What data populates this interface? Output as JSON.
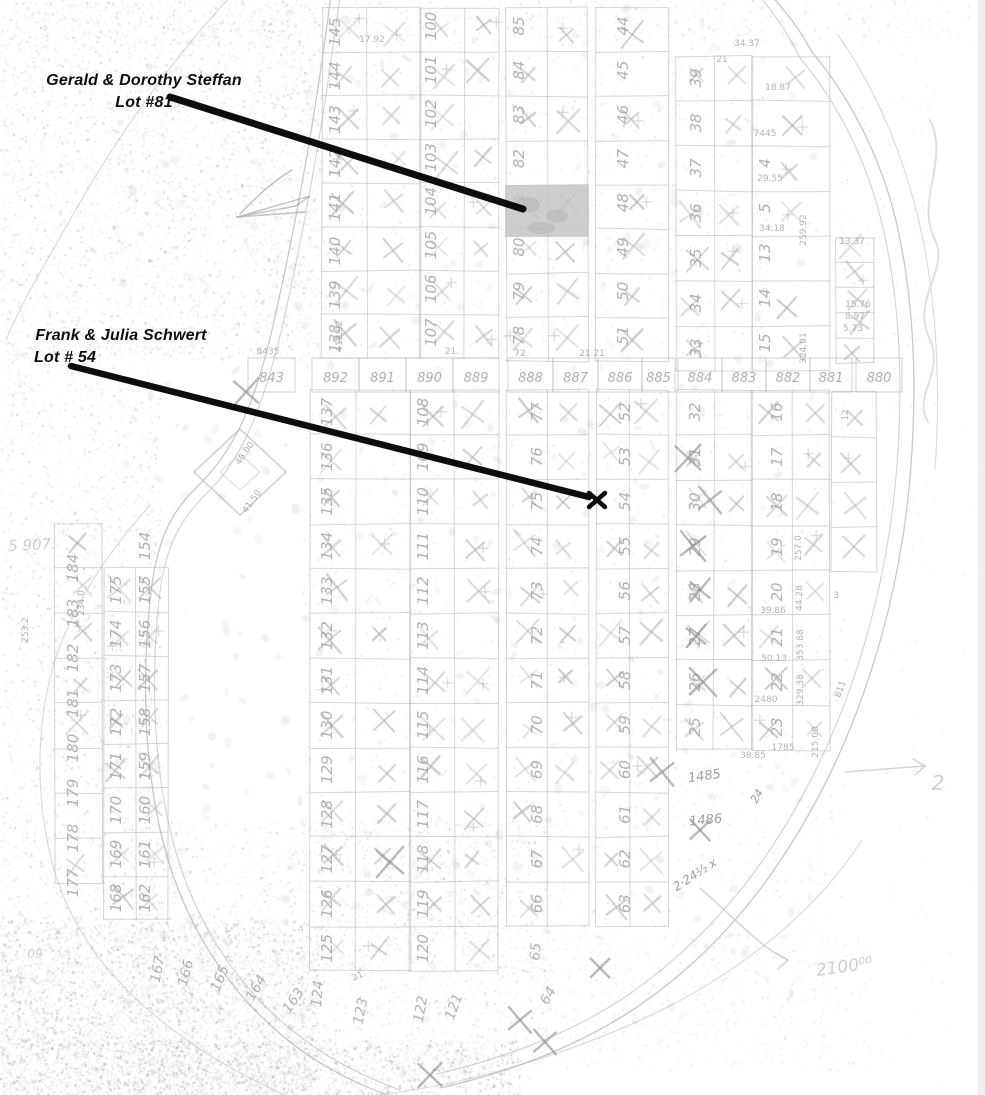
{
  "document": {
    "kind": "scanned plat map with ownership annotations"
  },
  "colors": {
    "background": "#ffffff",
    "annotation_ink": "#0d0d0d",
    "map_line_ink": "#b6b6b6",
    "lot_number_ink": "#a2a2a2",
    "dimension_ink": "#a6a6a6",
    "pencil_ink": "#8d8d8d",
    "handwriting_ink": "#c9c9c9",
    "highlight_fill": "#c5c5c5"
  },
  "annotations": {
    "steffan": {
      "name_line": "Gerald & Dorothy Steffan",
      "lot_line": "Lot #81",
      "pointer": {
        "x1": 170,
        "y1": 97,
        "x2": 523,
        "y2": 209,
        "width": 7
      },
      "highlight": {
        "x": 505,
        "y": 185,
        "w": 84,
        "h": 52
      }
    },
    "schwert": {
      "name_line": "Frank & Julia Schwert",
      "lot_line": "Lot # 54",
      "pointer": {
        "x1": 71,
        "y1": 366,
        "x2": 589,
        "y2": 497,
        "width": 6.5
      },
      "marker": {
        "symbol": "x",
        "x": 597,
        "y": 500
      }
    }
  },
  "map": {
    "middle_band": {
      "y": 358,
      "h": 34,
      "lots": [
        {
          "n": "843",
          "x": 248,
          "w": 47
        },
        {
          "n": "892",
          "x": 312,
          "w": 47
        },
        {
          "n": "891",
          "x": 359,
          "w": 47
        },
        {
          "n": "890",
          "x": 406,
          "w": 47
        },
        {
          "n": "889",
          "x": 453,
          "w": 46
        },
        {
          "n": "888",
          "x": 508,
          "w": 45
        },
        {
          "n": "887",
          "x": 553,
          "w": 45
        },
        {
          "n": "886",
          "x": 598,
          "w": 44
        },
        {
          "n": "885",
          "x": 642,
          "w": 33
        },
        {
          "n": "884",
          "x": 678,
          "w": 44
        },
        {
          "n": "883",
          "x": 722,
          "w": 44
        },
        {
          "n": "882",
          "x": 766,
          "w": 44
        },
        {
          "n": "881",
          "x": 810,
          "w": 42
        },
        {
          "n": "880",
          "x": 856,
          "w": 46
        }
      ]
    },
    "grids": [
      {
        "x0": 322,
        "x1": 420,
        "mid": 367,
        "y0": 8,
        "rowH": 43.8,
        "n": 8
      },
      {
        "x0": 420,
        "x1": 498,
        "mid": 464,
        "y0": 8,
        "rowH": 43.8,
        "n": 8
      },
      {
        "x0": 506,
        "x1": 588,
        "mid": 548,
        "y0": 8,
        "rowH": 44.2,
        "n": 8
      },
      {
        "x0": 596,
        "x1": 668,
        "mid": 0,
        "y0": 8,
        "rowH": 44.2,
        "n": 8
      },
      {
        "x0": 676,
        "x1": 752,
        "mid": 714,
        "y0": 56,
        "rowH": 45,
        "n": 7
      },
      {
        "x0": 752,
        "x1": 830,
        "mid": 0,
        "y0": 56,
        "rowH": 45,
        "n": 7
      },
      {
        "x0": 836,
        "x1": 874,
        "mid": 0,
        "y0": 238,
        "rowH": 25,
        "n": 5
      },
      {
        "x0": 55,
        "x1": 102,
        "mid": 0,
        "y0": 523,
        "rowH": 45,
        "n": 8
      },
      {
        "x0": 104,
        "x1": 168,
        "mid": 136,
        "y0": 568,
        "rowH": 44,
        "n": 8
      },
      {
        "x0": 310,
        "x1": 410,
        "mid": 356,
        "y0": 390,
        "rowH": 44.7,
        "n": 13
      },
      {
        "x0": 410,
        "x1": 498,
        "mid": 455,
        "y0": 390,
        "rowH": 44.7,
        "n": 13
      },
      {
        "x0": 506,
        "x1": 588,
        "mid": 548,
        "y0": 390,
        "rowH": 44.7,
        "n": 12
      },
      {
        "x0": 596,
        "x1": 668,
        "mid": 630,
        "y0": 390,
        "rowH": 44.7,
        "n": 12
      },
      {
        "x0": 676,
        "x1": 752,
        "mid": 714,
        "y0": 390,
        "rowH": 45,
        "n": 8
      },
      {
        "x0": 752,
        "x1": 830,
        "mid": 792,
        "y0": 390,
        "rowH": 45,
        "n": 8
      },
      {
        "x0": 832,
        "x1": 876,
        "mid": 0,
        "y0": 392,
        "rowH": 45,
        "n": 4
      }
    ],
    "number_columns": [
      {
        "x": 340,
        "cy0": 32,
        "rowH": 43.8,
        "nums": [
          "145",
          "144",
          "143",
          "142",
          "141",
          "140",
          "139",
          "138"
        ]
      },
      {
        "x": 436,
        "cy0": 26,
        "rowH": 43.8,
        "nums": [
          "100",
          "101",
          "102",
          "103",
          "104",
          "105",
          "106",
          "107"
        ]
      },
      {
        "x": 524,
        "cy0": 26,
        "rowH": 44.2,
        "nums": [
          "85",
          "84",
          "83",
          "82",
          "81",
          "80",
          "79",
          "78"
        ]
      },
      {
        "x": 628,
        "cy0": 26,
        "rowH": 44.2,
        "nums": [
          "44",
          "45",
          "46",
          "47",
          "48",
          "49",
          "50",
          "51"
        ]
      },
      {
        "x": 701,
        "cy0": 78,
        "rowH": 45,
        "nums": [
          "39",
          "38",
          "37",
          "36",
          "35",
          "34",
          "33"
        ]
      },
      {
        "x": 770,
        "cy0": 163,
        "rowH": 45,
        "nums": [
          "4",
          "5",
          "13",
          "14",
          "15"
        ]
      },
      {
        "x": 78,
        "cy0": 568,
        "rowH": 45,
        "nums": [
          "184",
          "183",
          "182",
          "181",
          "180",
          "179",
          "178",
          "177"
        ]
      },
      {
        "x": 121,
        "cy0": 590,
        "rowH": 44,
        "nums": [
          "175",
          "174",
          "173",
          "172",
          "171",
          "170",
          "169",
          "168"
        ]
      },
      {
        "x": 150,
        "cy0": 546,
        "rowH": 44,
        "nums": [
          "154",
          "155",
          "156",
          "157",
          "158",
          "159",
          "160",
          "161",
          "162"
        ]
      },
      {
        "x": 332,
        "cy0": 412,
        "rowH": 44.7,
        "nums": [
          "137",
          "136",
          "135",
          "134",
          "133",
          "132",
          "131",
          "130",
          "129",
          "128",
          "127",
          "126",
          "125"
        ]
      },
      {
        "x": 428,
        "cy0": 412,
        "rowH": 44.7,
        "nums": [
          "108",
          "109",
          "110",
          "111",
          "112",
          "113",
          "114",
          "115",
          "116",
          "117",
          "118",
          "119",
          "120"
        ]
      },
      {
        "x": 542,
        "cy0": 412,
        "rowH": 44.7,
        "nums": [
          "77",
          "76",
          "75",
          "74",
          "73",
          "72",
          "71",
          "70",
          "69",
          "68",
          "67",
          "66"
        ]
      },
      {
        "x": 630,
        "cy0": 412,
        "rowH": 44.7,
        "nums": [
          "52",
          "53",
          "54",
          "55",
          "56",
          "57",
          "58",
          "59",
          "60",
          "61",
          "62",
          "63"
        ]
      },
      {
        "x": 700,
        "cy0": 412,
        "rowH": 45,
        "nums": [
          "32",
          "31",
          "30",
          "29",
          "28",
          "27",
          "26",
          "25"
        ]
      },
      {
        "x": 782,
        "cy0": 412,
        "rowH": 45,
        "nums": [
          "16",
          "17",
          "18",
          "19",
          "20",
          "21",
          "22",
          "23"
        ]
      }
    ],
    "extra_numbers": [
      {
        "t": "167",
        "x": 162,
        "y": 970,
        "rot": -80
      },
      {
        "t": "166",
        "x": 190,
        "y": 974,
        "rot": -75
      },
      {
        "t": "165",
        "x": 224,
        "y": 980,
        "rot": -68
      },
      {
        "t": "164",
        "x": 260,
        "y": 990,
        "rot": -60
      },
      {
        "t": "163",
        "x": 297,
        "y": 1003,
        "rot": -55
      },
      {
        "t": "124",
        "x": 322,
        "y": 994,
        "rot": -85
      },
      {
        "t": "123",
        "x": 365,
        "y": 1012,
        "rot": -78
      },
      {
        "t": "122",
        "x": 425,
        "y": 1010,
        "rot": -80
      },
      {
        "t": "121",
        "x": 458,
        "y": 1008,
        "rot": -70
      },
      {
        "t": "65",
        "x": 540,
        "y": 952,
        "rot": -85
      },
      {
        "t": "64",
        "x": 552,
        "y": 998,
        "rot": -60
      }
    ],
    "dimensions": [
      {
        "t": "17.92",
        "x": 372,
        "y": 42,
        "rot": 0
      },
      {
        "t": "34.37",
        "x": 747,
        "y": 46,
        "rot": 0
      },
      {
        "t": "18.87",
        "x": 778,
        "y": 90,
        "rot": 0
      },
      {
        "t": "7445",
        "x": 765,
        "y": 136,
        "rot": 0
      },
      {
        "t": "259.92",
        "x": 806,
        "y": 230,
        "rot": -90
      },
      {
        "t": "324.01",
        "x": 806,
        "y": 348,
        "rot": -90
      },
      {
        "t": "29.55",
        "x": 770,
        "y": 181,
        "rot": 0
      },
      {
        "t": "34.18",
        "x": 772,
        "y": 231,
        "rot": 0
      },
      {
        "t": "21",
        "x": 722,
        "y": 62,
        "rot": 0
      },
      {
        "t": "8435",
        "x": 268,
        "y": 354,
        "rot": 0
      },
      {
        "t": "412.92",
        "x": 342,
        "y": 336,
        "rot": -90
      },
      {
        "t": "21.",
        "x": 452,
        "y": 354,
        "rot": 0
      },
      {
        "t": "21  21",
        "x": 592,
        "y": 356,
        "rot": 0
      },
      {
        "t": "72",
        "x": 520,
        "y": 356,
        "rot": 0
      },
      {
        "t": "253.2",
        "x": 28,
        "y": 630,
        "rot": -90
      },
      {
        "t": "234.0",
        "x": 84,
        "y": 603,
        "rot": -90
      },
      {
        "t": "46.00",
        "x": 247,
        "y": 455,
        "rot": -55
      },
      {
        "t": "41.50",
        "x": 254,
        "y": 503,
        "rot": -55
      },
      {
        "t": "257.0",
        "x": 801,
        "y": 548,
        "rot": -90
      },
      {
        "t": "44.28",
        "x": 802,
        "y": 598,
        "rot": -90
      },
      {
        "t": "39.86",
        "x": 773,
        "y": 613,
        "rot": 0
      },
      {
        "t": "353.88",
        "x": 803,
        "y": 645,
        "rot": -90
      },
      {
        "t": "50.13",
        "x": 774,
        "y": 661,
        "rot": 0
      },
      {
        "t": "329.38",
        "x": 803,
        "y": 690,
        "rot": -90
      },
      {
        "t": "2480",
        "x": 766,
        "y": 702,
        "rot": 0
      },
      {
        "t": "1785",
        "x": 783,
        "y": 750,
        "rot": 0
      },
      {
        "t": "38.85",
        "x": 753,
        "y": 758,
        "rot": 0
      },
      {
        "t": "215.00",
        "x": 818,
        "y": 742,
        "rot": -90
      },
      {
        "t": "15.76",
        "x": 858,
        "y": 307,
        "rot": 0
      },
      {
        "t": "8.97",
        "x": 855,
        "y": 319,
        "rot": 0
      },
      {
        "t": "5.73",
        "x": 853,
        "y": 331,
        "rot": 0
      },
      {
        "t": "13.37",
        "x": 852,
        "y": 244,
        "rot": 0
      },
      {
        "t": "21.",
        "x": 360,
        "y": 978,
        "rot": -25
      },
      {
        "t": "811",
        "x": 843,
        "y": 690,
        "rot": -70
      },
      {
        "t": "3",
        "x": 836,
        "y": 598,
        "rot": 0
      },
      {
        "t": "12",
        "x": 848,
        "y": 415,
        "rot": -90
      }
    ],
    "pencil_notes": [
      {
        "t": "1485",
        "x": 705,
        "y": 780,
        "rot": -8,
        "size": 13
      },
      {
        "t": "1486",
        "x": 706,
        "y": 824,
        "rot": -5,
        "size": 13
      },
      {
        "t": "2·24½ x",
        "x": 697,
        "y": 878,
        "rot": -33,
        "size": 12
      },
      {
        "t": "24",
        "x": 760,
        "y": 798,
        "rot": -60,
        "size": 11
      }
    ],
    "pencil_x_marks": [
      {
        "x": 688,
        "y": 458
      },
      {
        "x": 710,
        "y": 500
      },
      {
        "x": 693,
        "y": 546
      },
      {
        "x": 700,
        "y": 590
      },
      {
        "x": 696,
        "y": 636
      },
      {
        "x": 703,
        "y": 682
      },
      {
        "x": 662,
        "y": 772
      },
      {
        "x": 700,
        "y": 830
      },
      {
        "x": 545,
        "y": 1042
      },
      {
        "x": 430,
        "y": 1075
      },
      {
        "x": 600,
        "y": 968
      },
      {
        "x": 390,
        "y": 862
      },
      {
        "x": 246,
        "y": 392
      },
      {
        "x": 520,
        "y": 1020
      }
    ],
    "handwriting": [
      {
        "t": "2",
        "x": 938,
        "y": 790,
        "size": 20,
        "rot": 0
      },
      {
        "t": "2100⁰⁰",
        "x": 845,
        "y": 972,
        "size": 17,
        "rot": -8
      },
      {
        "t": "5 907",
        "x": 30,
        "y": 550,
        "size": 15,
        "rot": -3
      },
      {
        "t": "09",
        "x": 35,
        "y": 958,
        "size": 12,
        "rot": 0
      }
    ],
    "hand_arrows": [
      {
        "d": "M845,772 L925,766"
      },
      {
        "d": "M700,888 C745,928 762,948 788,960"
      }
    ],
    "squiggle": "M930,120 C950,160 915,200 935,240 C950,270 910,300 930,340 C945,372 912,396 928,422",
    "roads": [
      {
        "d1": "M331,-5 C315,120 295,230 272,330 C252,415 230,455 196,488 C168,515 156,545 150,600 C143,670 143,745 158,820 C172,888 200,950 250,1005 C295,1053 340,1078 395,1098",
        "d2": "M340,-5 C324,120 304,232 281,332 C261,414 240,462 206,494 C178,522 165,548 159,600 C152,668 152,742 167,816 C181,884 208,944 257,998 C301,1044 346,1070 400,1090"
      },
      {
        "d1": "M768,-8 C792,18 802,34 812,52 C852,100 882,160 897,225 C912,292 916,360 913,430 C910,512 897,590 872,668 C848,744 812,818 764,884 C728,933 686,973 640,1005 C580,1046 510,1072 440,1088",
        "d2": "M756,-8 C780,20 790,38 800,58 C840,106 868,164 883,228 C898,293 902,360 899,430 C896,510 883,586 859,662 C835,737 800,810 753,874 C717,922 676,961 631,993 C573,1033 505,1058 437,1074"
      }
    ],
    "shorelines": [
      "M232,-5 C180,50 120,130 70,220 C40,272 18,310 6,340",
      "M150,505 C110,550 75,600 55,660 C38,715 35,780 48,845 C60,905 88,950 125,988 C170,1034 225,1068 285,1095",
      "M838,35 C880,95 910,170 925,250 C938,322 940,400 935,470",
      "M862,840 C820,905 760,955 690,995 C620,1034 540,1062 455,1082 C395,1095 340,1100 300,1100"
    ],
    "diamond": {
      "cx": 240,
      "cy": 472,
      "rx": 46,
      "ry": 43
    },
    "sliver_glyph": [
      "M237,217 L310,196 L296,206 L237,217",
      "M240,214 C258,195 275,180 292,170",
      "M237,217 L305,212"
    ]
  }
}
